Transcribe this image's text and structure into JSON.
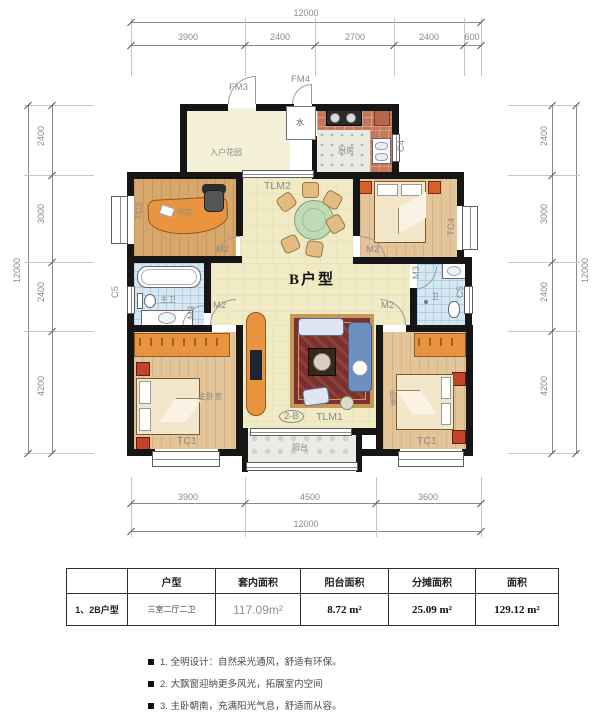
{
  "unit_label": "B户型",
  "plan": {
    "rooms": {
      "entry_garden": "入户花园",
      "kitchen": "厨房",
      "study": "书房",
      "master_bath": "主卫",
      "bath": "卫",
      "master_bedroom": "主卧室",
      "bedroom": "卧室",
      "balcony": "阳台"
    },
    "codes": {
      "fm3": "FM3",
      "fm4": "FM4",
      "water": "水",
      "tlm2": "TLM2",
      "tlm1": "TLM1",
      "tc1": "TC1",
      "tc2": "TC2",
      "tc4": "TC4",
      "c4": "C4",
      "c5": "C5",
      "m2": "M2",
      "m3": "M3",
      "unit_tag": "2-B"
    }
  },
  "dimensions": {
    "top": {
      "total": "12000",
      "segments": [
        "3900",
        "2400",
        "2700",
        "2400",
        "600"
      ]
    },
    "bottom": {
      "total": "12000",
      "segments": [
        "3900",
        "4500",
        "3600"
      ]
    },
    "left": {
      "total": "12000",
      "segments": [
        "2400",
        "3000",
        "2400",
        "4200"
      ]
    },
    "right": {
      "total": "12000",
      "segments": [
        "2400",
        "3000",
        "2400",
        "4200"
      ]
    }
  },
  "table": {
    "headers": [
      "",
      "户型",
      "套内面积",
      "阳台面积",
      "分摊面积",
      "面积"
    ],
    "row": {
      "name": "1、2B户型",
      "layout": "三室二厅二卫",
      "interior_area": "117.09m²",
      "balcony_area": "8.72 m²",
      "shared_area": "25.09 m²",
      "total_area": "129.12 m²"
    }
  },
  "notes": [
    "1. 全明设计：自然采光通风，舒适有环保。",
    "2. 大飘窗迎纳更多风光，拓展室内空间",
    "3. 主卧朝南，充满阳光气息，舒适而从容。"
  ],
  "colors": {
    "wall": "#161616",
    "wood_floor": "#e4c59a",
    "living_floor": "#f0ebc5",
    "bath_tile": "#d4e7f2",
    "furniture_orange": "#ea9440",
    "rug_red": "#7c3030",
    "sofa_blue": "#6f8fc0",
    "dim_gray": "#8a8a8a"
  }
}
